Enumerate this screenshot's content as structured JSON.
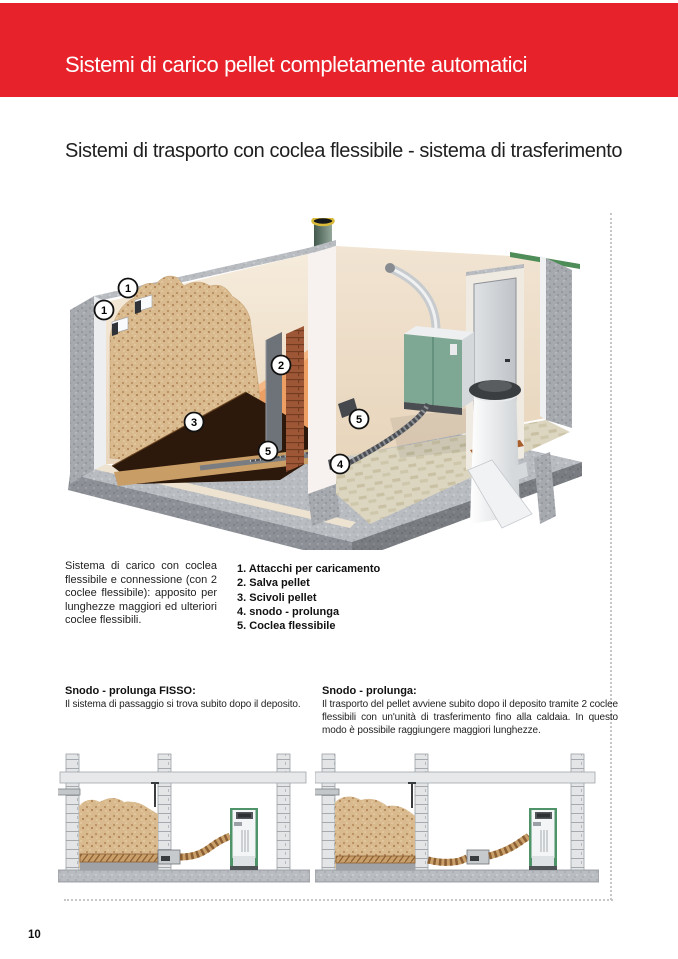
{
  "header": {
    "title": "Sistemi di carico pellet completamente automatici"
  },
  "subtitle": "Sistemi di trasporto con coclea flessibile - sistema di trasferimento",
  "description": {
    "paragraph": "Sistema di carico con coclea flessibile e connessione (con 2 coclee flessibile): apposito per lunghezze maggiori ed ulteriori coclee flessibili.",
    "legend": [
      {
        "num": "1.",
        "label": "Attacchi per caricamento"
      },
      {
        "num": "2.",
        "label": "Salva pellet"
      },
      {
        "num": "3.",
        "label": "Scivoli pellet"
      },
      {
        "num": "4.",
        "label": "snodo - prolunga"
      },
      {
        "num": "5.",
        "label": "Coclea flessibile"
      }
    ]
  },
  "sections": {
    "left": {
      "heading": "Snodo - prolunga FISSO:",
      "body": "Il sistema di passaggio si trova subito dopo il deposito."
    },
    "right": {
      "heading": "Snodo - prolunga:",
      "body": "Il trasporto del pellet avviene subito dopo il deposito tramite 2 coclee flessibili con un'unità di trasferimento fino alla caldaia. In questo modo è possibile raggiungere maggiori lunghezze."
    }
  },
  "illustration": {
    "badges": [
      {
        "n": "1"
      },
      {
        "n": "1"
      },
      {
        "n": "2"
      },
      {
        "n": "3"
      },
      {
        "n": "5"
      },
      {
        "n": "4"
      },
      {
        "n": "5"
      }
    ]
  },
  "page": {
    "number": "10"
  },
  "colors": {
    "accent_red": "#e8222a",
    "pellet_tan": "#d9b98f",
    "boiler_green": "#7fa894",
    "concrete_gray": "#a6aaaf"
  }
}
